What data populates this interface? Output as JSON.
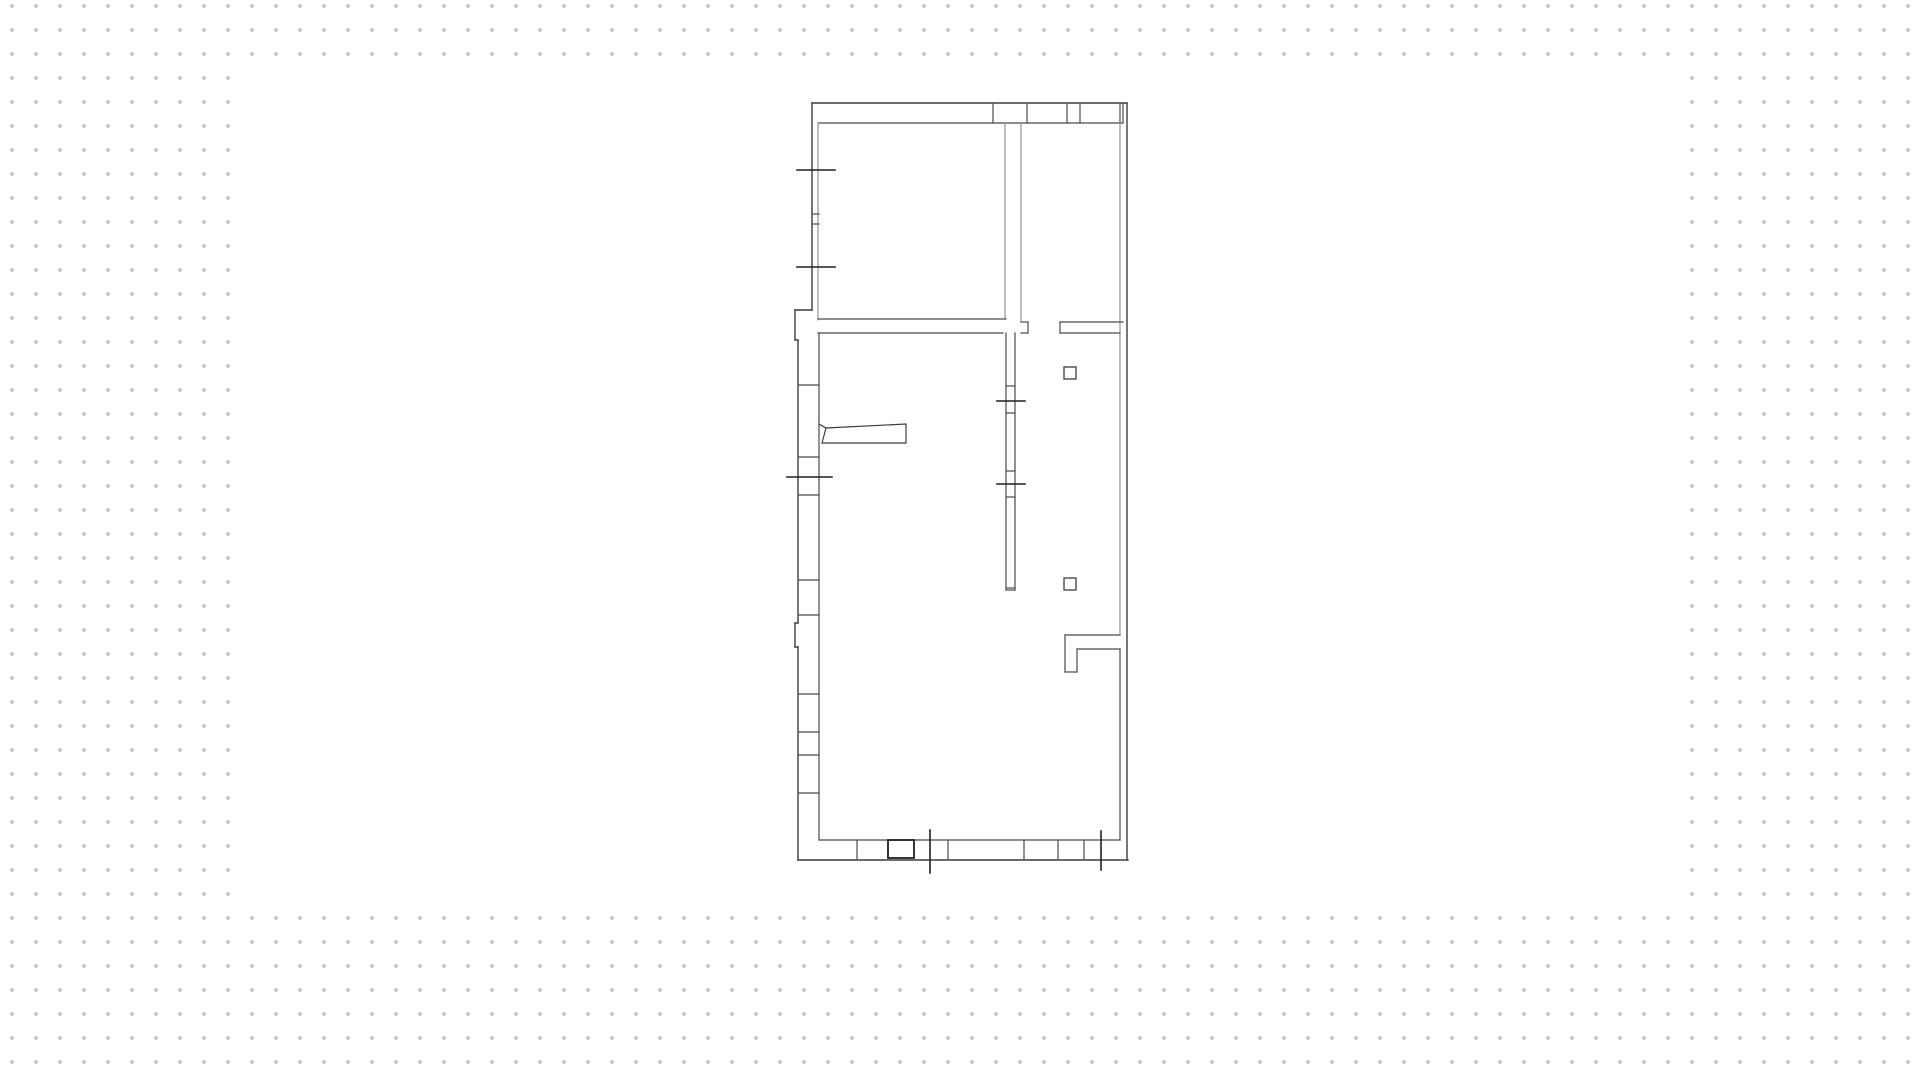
{
  "canvas": {
    "background_color": "#ffffff",
    "dot_color": "#bcbfc3",
    "dot_spacing": 24,
    "dot_size": 3.2,
    "dot_offset_x": 12,
    "dot_offset_y": 6,
    "sheet": {
      "x": 234,
      "y": 66,
      "width": 1450,
      "height": 840,
      "color": "#ffffff"
    }
  },
  "floor_plan": {
    "description": "architectural-floor-plan",
    "colors": {
      "wall": "#3d3d3d",
      "light": "#8a8a8a",
      "dark": "#1f1f1f"
    },
    "groups": [
      {
        "name": "exterior-walls",
        "stroke": "#3d3d3d",
        "width": 1.4,
        "lines": [
          [
            812,
            103,
            1127,
            103
          ],
          [
            1127,
            103,
            1127,
            860
          ],
          [
            798,
            860,
            1128,
            860
          ],
          [
            812,
            103,
            812,
            310
          ],
          [
            795,
            310,
            812,
            310
          ],
          [
            795,
            310,
            795,
            340
          ],
          [
            795,
            340,
            798,
            340
          ],
          [
            798,
            340,
            798,
            623
          ],
          [
            795,
            623,
            798,
            623
          ],
          [
            795,
            623,
            795,
            647
          ],
          [
            795,
            647,
            798,
            647
          ],
          [
            798,
            647,
            798,
            860
          ]
        ]
      },
      {
        "name": "top-wall-windows",
        "stroke": "#4a4a4a",
        "width": 1.2,
        "lines": [
          [
            818,
            123,
            1123,
            123
          ],
          [
            993,
            103,
            993,
            123
          ],
          [
            1027,
            103,
            1027,
            123
          ],
          [
            1067,
            103,
            1067,
            123
          ],
          [
            1080,
            103,
            1080,
            123
          ],
          [
            1120,
            103,
            1120,
            123
          ],
          [
            1123,
            103,
            1123,
            123
          ]
        ]
      },
      {
        "name": "interior-room-walls",
        "stroke": "#8a8a8a",
        "width": 1.1,
        "lines": [
          [
            818,
            123,
            818,
            320
          ],
          [
            1005,
            123,
            1005,
            319
          ],
          [
            1021,
            123,
            1021,
            322
          ],
          [
            1120,
            123,
            1120,
            635
          ]
        ]
      },
      {
        "name": "interior-walls",
        "stroke": "#4a4a4a",
        "width": 1.2,
        "lines": [
          [
            812,
            214,
            819,
            214
          ],
          [
            812,
            224,
            819,
            224
          ],
          [
            818,
            319,
            1006,
            319
          ],
          [
            818,
            333,
            1003,
            333
          ],
          [
            819,
            333,
            819,
            840
          ],
          [
            1021,
            322,
            1028,
            322
          ],
          [
            1028,
            322,
            1028,
            333
          ],
          [
            1021,
            333,
            1028,
            333
          ],
          [
            1006,
            333,
            1006,
            590
          ],
          [
            1015,
            333,
            1015,
            590
          ],
          [
            1006,
            386,
            1015,
            386
          ],
          [
            1006,
            413,
            1015,
            413
          ],
          [
            1006,
            471,
            1015,
            471
          ],
          [
            1006,
            497,
            1015,
            497
          ],
          [
            1006,
            588,
            1015,
            588
          ],
          [
            1006,
            590,
            1015,
            590
          ],
          [
            1060,
            322,
            1123,
            322
          ],
          [
            1060,
            333,
            1120,
            333
          ],
          [
            1060,
            322,
            1060,
            333
          ],
          [
            1120,
            635,
            1065,
            635
          ],
          [
            1065,
            635,
            1065,
            672
          ],
          [
            1065,
            672,
            1077,
            672
          ],
          [
            1077,
            649,
            1077,
            672
          ],
          [
            1077,
            649,
            1120,
            649
          ],
          [
            1120,
            649,
            1120,
            840
          ],
          [
            819,
            840,
            1120,
            840
          ]
        ]
      },
      {
        "name": "left-wall-window-dividers",
        "stroke": "#4a4a4a",
        "width": 1.2,
        "lines": [
          [
            798,
            385,
            819,
            385
          ],
          [
            798,
            457,
            819,
            457
          ],
          [
            798,
            495,
            819,
            495
          ],
          [
            798,
            580,
            819,
            580
          ],
          [
            798,
            615,
            819,
            615
          ],
          [
            798,
            694,
            819,
            694
          ],
          [
            798,
            732,
            819,
            732
          ],
          [
            798,
            755,
            819,
            755
          ],
          [
            798,
            793,
            819,
            793
          ]
        ]
      },
      {
        "name": "bottom-wall-window-dividers",
        "stroke": "#4a4a4a",
        "width": 1.2,
        "lines": [
          [
            857,
            840,
            857,
            860
          ],
          [
            948,
            840,
            948,
            860
          ],
          [
            1024,
            840,
            1024,
            860
          ],
          [
            1058,
            840,
            1058,
            860
          ],
          [
            1084,
            840,
            1084,
            860
          ]
        ]
      },
      {
        "name": "window-ticks",
        "stroke": "#1f1f1f",
        "width": 1.6,
        "lines": [
          [
            797,
            170,
            835,
            170
          ],
          [
            797,
            267,
            835,
            267
          ],
          [
            787,
            477,
            832,
            477
          ],
          [
            997,
            401,
            1025,
            401
          ],
          [
            997,
            484,
            1025,
            484
          ],
          [
            930,
            830,
            930,
            873
          ],
          [
            1101,
            831,
            1101,
            870
          ]
        ]
      }
    ],
    "fixtures": {
      "name": "outlet-squares",
      "stroke": "#3d3d3d",
      "width": 1.3,
      "rects": [
        {
          "x": 1064,
          "y": 367,
          "w": 12,
          "h": 12
        },
        {
          "x": 1064,
          "y": 578,
          "w": 12,
          "h": 12
        }
      ]
    },
    "threshold": {
      "name": "bottom-door-cell",
      "stroke": "#1f1f1f",
      "width": 1.8,
      "rect": {
        "x": 888,
        "y": 840,
        "w": 26,
        "h": 18
      }
    },
    "door": {
      "name": "door-leaf",
      "stroke": "#3d3d3d",
      "width": 1.2,
      "polygon": [
        [
          822,
          443
        ],
        [
          906,
          443
        ],
        [
          906,
          424
        ],
        [
          826,
          428
        ]
      ],
      "hinge_line": [
        819,
        424,
        826,
        428
      ]
    }
  }
}
